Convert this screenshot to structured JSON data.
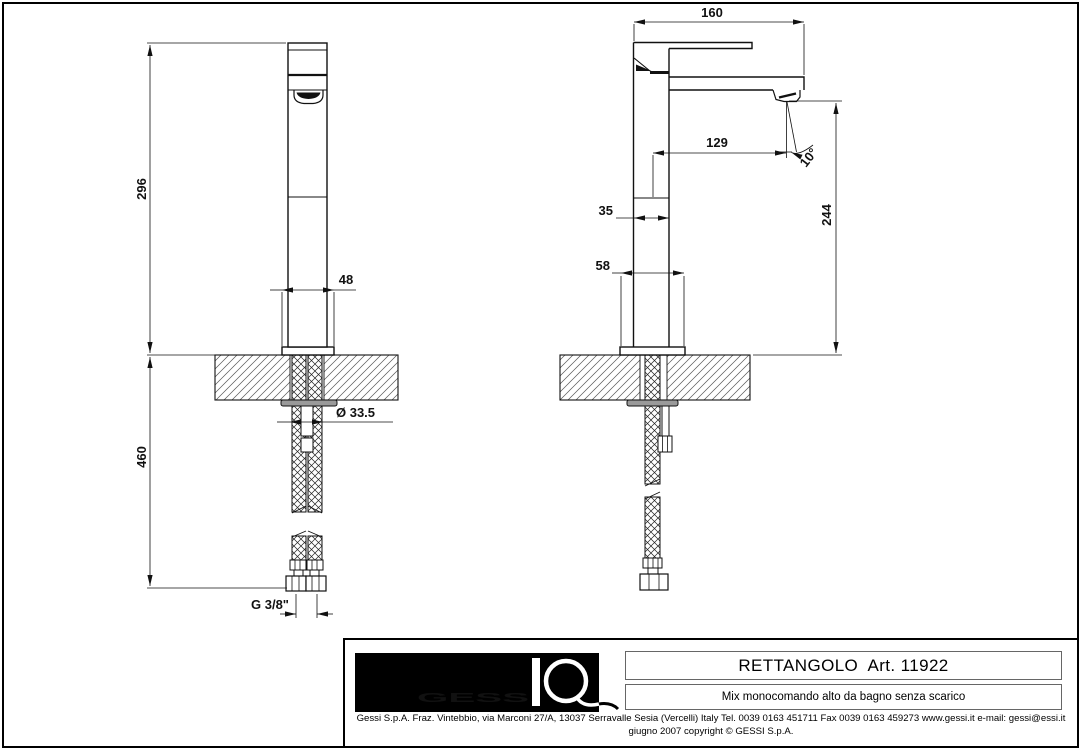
{
  "colors": {
    "line": "#111111",
    "paper": "#ffffff",
    "flange": "#9a9a9a"
  },
  "dims": {
    "height": "296",
    "base_width": "48",
    "below_length": "460",
    "hole_dia": "Ø 33.5",
    "thread": "G 3/8\"",
    "depth_total": "160",
    "reach": "129",
    "angle": "10°",
    "body_depth": "35",
    "base_depth": "58",
    "spout_height": "244"
  },
  "title_block": {
    "logo_letters": "GESS",
    "logo_name": "GESSI",
    "product_title": "RETTANGOLO  Art. 11922",
    "product_description": "Mix monocomando alto da bagno senza scarico",
    "company_info": "Gessi S.p.A. Fraz. Vintebbio, via Marconi 27/A, 13037 Serravalle Sesia  (Vercelli) Italy Tel. 0039 0163 451711 Fax 0039 0163 459273 www.gessi.it  e-mail: gessi@essi.it",
    "copyright_line": "giugno 2007 copyright © GESSI S.p.A."
  }
}
